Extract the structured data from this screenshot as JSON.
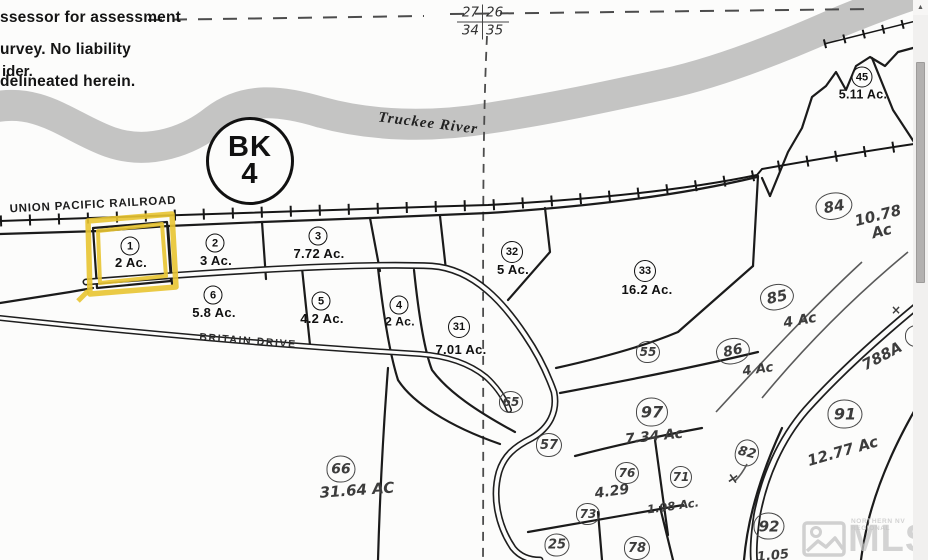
{
  "map": {
    "disclaimer": {
      "lines": [
        "ssessor for assessment",
        "urvey.  No liability",
        "delineated herein."
      ],
      "extra": "ider."
    },
    "section_corner": {
      "tl": "27",
      "tr": "26",
      "bl": "34",
      "br": "35"
    },
    "book_badge": {
      "line1": "BK",
      "line2": "4"
    },
    "river_label": "Truckee River",
    "railroad_label": "UNION PACIFIC RAILROAD",
    "road_label": "BRITAIN DRIVE",
    "highlight_color": "#E8C431",
    "river_color": "#b5b5b5",
    "parcels": [
      {
        "num": "1",
        "acres": "2 Ac.",
        "nx": 130,
        "ny": 246,
        "ax": 131,
        "ay": 263,
        "w": 19,
        "h": 19,
        "fs": 11,
        "afs": 13,
        "style": "printed"
      },
      {
        "num": "2",
        "acres": "3 Ac.",
        "nx": 215,
        "ny": 243,
        "ax": 216,
        "ay": 261,
        "w": 19,
        "h": 19,
        "fs": 11,
        "afs": 13,
        "style": "printed"
      },
      {
        "num": "3",
        "acres": "7.72 Ac.",
        "nx": 318,
        "ny": 236,
        "ax": 319,
        "ay": 254,
        "w": 19,
        "h": 19,
        "fs": 11,
        "afs": 13,
        "style": "printed"
      },
      {
        "num": "32",
        "acres": "5 Ac.",
        "nx": 512,
        "ny": 252,
        "ax": 513,
        "ay": 270,
        "w": 22,
        "h": 22,
        "fs": 11,
        "afs": 13,
        "style": "printed"
      },
      {
        "num": "33",
        "acres": "16.2 Ac.",
        "nx": 645,
        "ny": 271,
        "ax": 647,
        "ay": 290,
        "w": 22,
        "h": 22,
        "fs": 11,
        "afs": 13,
        "style": "printed"
      },
      {
        "num": "6",
        "acres": "5.8 Ac.",
        "nx": 213,
        "ny": 295,
        "ax": 214,
        "ay": 313,
        "w": 19,
        "h": 19,
        "fs": 11,
        "afs": 13,
        "style": "printed"
      },
      {
        "num": "5",
        "acres": "4.2 Ac.",
        "nx": 321,
        "ny": 301,
        "ax": 322,
        "ay": 319,
        "w": 19,
        "h": 19,
        "fs": 11,
        "afs": 13,
        "style": "printed"
      },
      {
        "num": "4",
        "acres": "2 Ac.",
        "nx": 399,
        "ny": 305,
        "ax": 400,
        "ay": 322,
        "w": 19,
        "h": 19,
        "fs": 11,
        "afs": 12,
        "style": "printed"
      },
      {
        "num": "31",
        "acres": "7.01 Ac.",
        "nx": 459,
        "ny": 327,
        "ax": 461,
        "ay": 350,
        "w": 22,
        "h": 22,
        "fs": 11,
        "afs": 13,
        "style": "printed"
      },
      {
        "num": "45",
        "acres": "5.11 Ac.",
        "nx": 862,
        "ny": 77,
        "ax": 863,
        "ay": 95,
        "w": 21,
        "h": 21,
        "fs": 11,
        "afs": 12.5,
        "style": "printed"
      },
      {
        "num": "84",
        "acres": "10.78 Ac",
        "nx": 834,
        "ny": 206,
        "ax": 880,
        "ay": 224,
        "w": 37,
        "h": 27,
        "fs": 15,
        "afs": 15,
        "rot": -10,
        "arot": -14,
        "style": "hand"
      },
      {
        "num": "85",
        "acres": "4 Ac",
        "nx": 777,
        "ny": 297,
        "ax": 800,
        "ay": 321,
        "w": 34,
        "h": 26,
        "fs": 15,
        "afs": 14,
        "rot": -12,
        "arot": -10,
        "style": "hand"
      },
      {
        "num": "86",
        "acres": "4 Ac",
        "nx": 733,
        "ny": 351,
        "ax": 758,
        "ay": 370,
        "w": 34,
        "h": 26,
        "fs": 14,
        "afs": 13,
        "rot": -12,
        "arot": -8,
        "style": "hand"
      },
      {
        "num": "55",
        "acres": "",
        "nx": 648,
        "ny": 352,
        "w": 24,
        "h": 22,
        "fs": 12,
        "style": "hand"
      },
      {
        "num": "65",
        "acres": "",
        "nx": 511,
        "ny": 402,
        "w": 24,
        "h": 22,
        "fs": 12,
        "style": "hand"
      },
      {
        "num": "57",
        "acres": "",
        "nx": 549,
        "ny": 445,
        "w": 26,
        "h": 24,
        "fs": 13,
        "style": "hand"
      },
      {
        "num": "97",
        "acres": "7.34 Ac",
        "nx": 652,
        "ny": 412,
        "ax": 654,
        "ay": 437,
        "w": 32,
        "h": 29,
        "fs": 16,
        "afs": 14,
        "arot": -6,
        "style": "hand"
      },
      {
        "num": "76",
        "acres": "4.29",
        "nx": 627,
        "ny": 473,
        "ax": 612,
        "ay": 492,
        "w": 24,
        "h": 22,
        "fs": 12,
        "afs": 14,
        "arot": -8,
        "style": "hand"
      },
      {
        "num": "71",
        "acres": "1.98\nAc.",
        "nx": 681,
        "ny": 477,
        "ax": 673,
        "ay": 506,
        "w": 22,
        "h": 22,
        "fs": 12,
        "afs": 11.5,
        "arot": -8,
        "style": "hand"
      },
      {
        "num": "73",
        "acres": "",
        "nx": 588,
        "ny": 514,
        "w": 24,
        "h": 22,
        "fs": 12,
        "style": "hand"
      },
      {
        "num": "25",
        "acres": "",
        "nx": 557,
        "ny": 545,
        "w": 25,
        "h": 23,
        "fs": 13,
        "style": "hand"
      },
      {
        "num": "78",
        "acres": "",
        "nx": 637,
        "ny": 548,
        "w": 26,
        "h": 24,
        "fs": 13,
        "style": "hand"
      },
      {
        "num": "82",
        "acres": "",
        "nx": 747,
        "ny": 453,
        "w": 24,
        "h": 27,
        "fs": 13,
        "rot": 14,
        "style": "hand"
      },
      {
        "num": "92",
        "acres": "",
        "nx": 769,
        "ny": 526,
        "w": 31,
        "h": 27,
        "fs": 15,
        "style": "hand"
      },
      {
        "num": "91",
        "acres": "12.77 Ac",
        "nx": 845,
        "ny": 414,
        "ax": 843,
        "ay": 452,
        "w": 35,
        "h": 29,
        "fs": 16,
        "afs": 15,
        "arot": -16,
        "style": "hand"
      },
      {
        "num": "66",
        "acres": "31.64 AC",
        "nx": 341,
        "ny": 469,
        "ax": 357,
        "ay": 491,
        "w": 29,
        "h": 27,
        "fs": 14,
        "afs": 15,
        "arot": -4,
        "style": "hand"
      },
      {
        "num": "8",
        "acres": "",
        "nx": 917,
        "ny": 336,
        "w": 24,
        "h": 22,
        "fs": 12,
        "style": "hand"
      }
    ],
    "notes": [
      {
        "text": "788A",
        "x": 882,
        "y": 356,
        "rot": -28,
        "fs": 15
      },
      {
        "text": "1.05",
        "x": 773,
        "y": 556,
        "rot": -6,
        "fs": 13
      },
      {
        "text": "×",
        "x": 733,
        "y": 479,
        "rot": 10,
        "fs": 14
      },
      {
        "text": "×",
        "x": 896,
        "y": 310,
        "rot": 0,
        "fs": 12
      }
    ]
  },
  "watermark": {
    "brand": "MLS",
    "tagline": "NORTHERN NV REGIONAL"
  },
  "scrollbar": {
    "up_arrow": "▲"
  }
}
